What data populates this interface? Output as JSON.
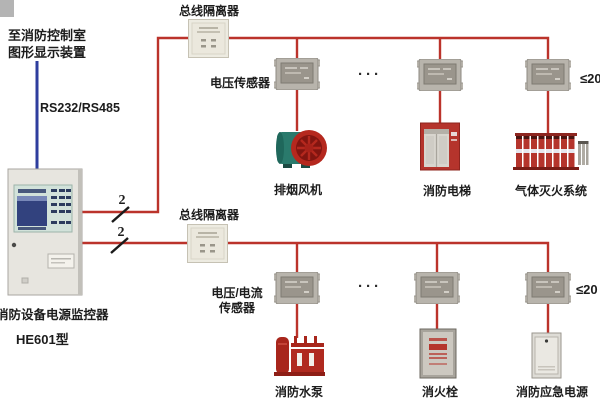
{
  "header": {
    "control_room_line1": "至消防控制室",
    "control_room_line2": "图形显示装置",
    "serial_link": "RS232/RS485"
  },
  "monitor": {
    "name": "消防设备电源监控器",
    "model": "HE601型"
  },
  "loop1": {
    "wire_count": "2",
    "isolator": "总线隔离器",
    "sensor": "电压传感器",
    "ellipsis": "···",
    "capacity": "≤20",
    "devices": [
      {
        "label": "排烟风机"
      },
      {
        "label": "消防电梯"
      },
      {
        "label": "气体灭火系统"
      }
    ]
  },
  "loop2": {
    "wire_count": "2",
    "isolator": "总线隔离器",
    "sensor_line1": "电压/电流",
    "sensor_line2": "传感器",
    "ellipsis": "···",
    "capacity": "≤20",
    "devices": [
      {
        "label": "消防水泵"
      },
      {
        "label": "消火栓"
      },
      {
        "label": "消防应急电源"
      }
    ]
  },
  "colors": {
    "bus_line": "#bb332b",
    "serial_line": "#2e3e9e",
    "device_red": "#b5342c",
    "fan_teal": "#2a7a6c",
    "cabinet_gray": "#e4e2dc"
  }
}
